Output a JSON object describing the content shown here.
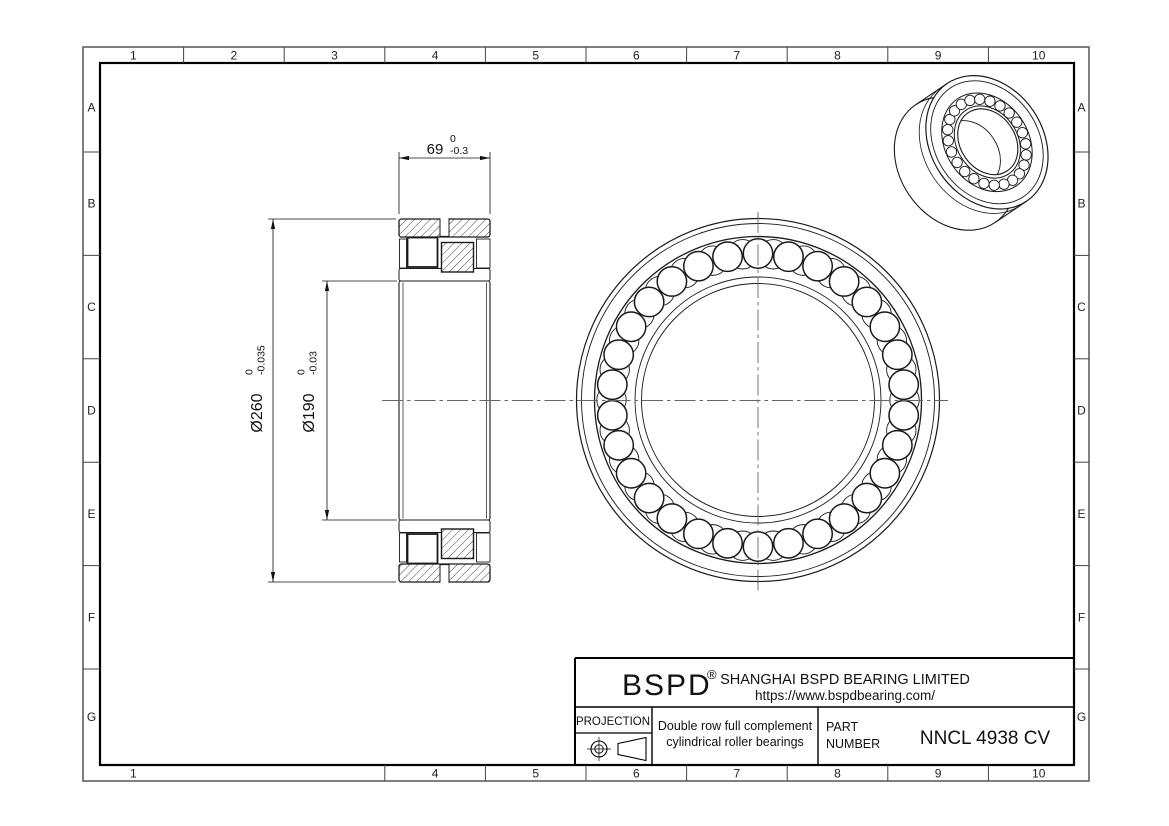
{
  "sheet": {
    "grid": {
      "columns": [
        "1",
        "2",
        "3",
        "4",
        "5",
        "6",
        "7",
        "8",
        "9",
        "10"
      ],
      "rows": [
        "A",
        "B",
        "C",
        "D",
        "E",
        "F",
        "G"
      ],
      "bottom_columns": [
        "1",
        "4",
        "5",
        "6",
        "7",
        "8",
        "9",
        "10"
      ]
    }
  },
  "dimensions": {
    "width": {
      "value": "69",
      "tol_upper": "0",
      "tol_lower": "-0.3"
    },
    "outer_diameter": {
      "value": "Ø260",
      "tol_upper": "0",
      "tol_lower": "-0.035"
    },
    "bore_diameter": {
      "value": "Ø190",
      "tol_upper": "0",
      "tol_lower": "-0.03"
    }
  },
  "title_block": {
    "brand": "BSPD",
    "registered_mark": "®",
    "company": "SHANGHAI BSPD BEARING LIMITED",
    "website": "https://www.bspdbearing.com/",
    "projection_label": "PROJECTION",
    "product_description_line1": "Double row full complement",
    "product_description_line2": "cylindrical roller bearings",
    "part_label_line1": "PART",
    "part_label_line2": "NUMBER",
    "part_number": "NNCL 4938 CV"
  },
  "colors": {
    "line": "#1a1a1a",
    "centerline": "#666666",
    "grid_line": "#555555",
    "background": "#ffffff"
  }
}
